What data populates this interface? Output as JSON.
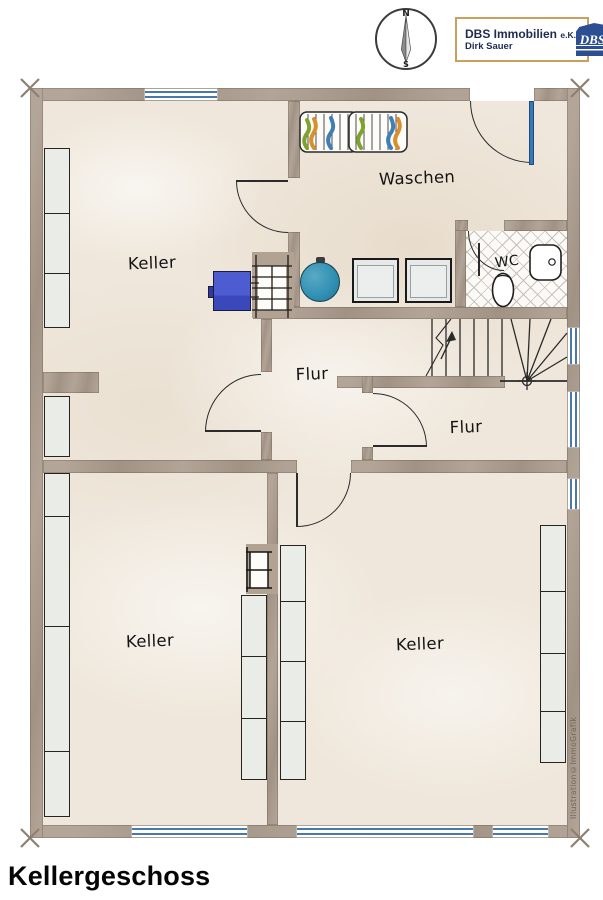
{
  "header": {
    "compass": {
      "north": "N",
      "south": "S"
    },
    "brand": {
      "company": "DBS Immobilien",
      "suffix": "e.K.",
      "owner": "Dirk Sauer",
      "monogram": "DBS"
    }
  },
  "rooms": {
    "keller_top": "Keller",
    "waschen": "Waschen",
    "wc": "WC",
    "flur_left": "Flur",
    "flur_right": "Flur",
    "keller_bottom_left": "Keller",
    "keller_bottom_right": "Keller"
  },
  "plan": {
    "watermark": "Illustration©ImmoGrafik"
  },
  "footer": {
    "title": "Kellergeschoss"
  },
  "colors": {
    "wall": "#a99a8b",
    "floor": "#efe7db",
    "window_blue": "#4779ad",
    "boiler_teal": "#2f8fb3",
    "appliance_blue": "#4455cc",
    "door_blue": "#3a77b5",
    "logo_gold": "#c9a05c",
    "logo_navy": "#1d2c4f",
    "rack_green": "#7fa12f",
    "rack_orange": "#d88f2f",
    "rack_blue": "#3f7fb5"
  }
}
